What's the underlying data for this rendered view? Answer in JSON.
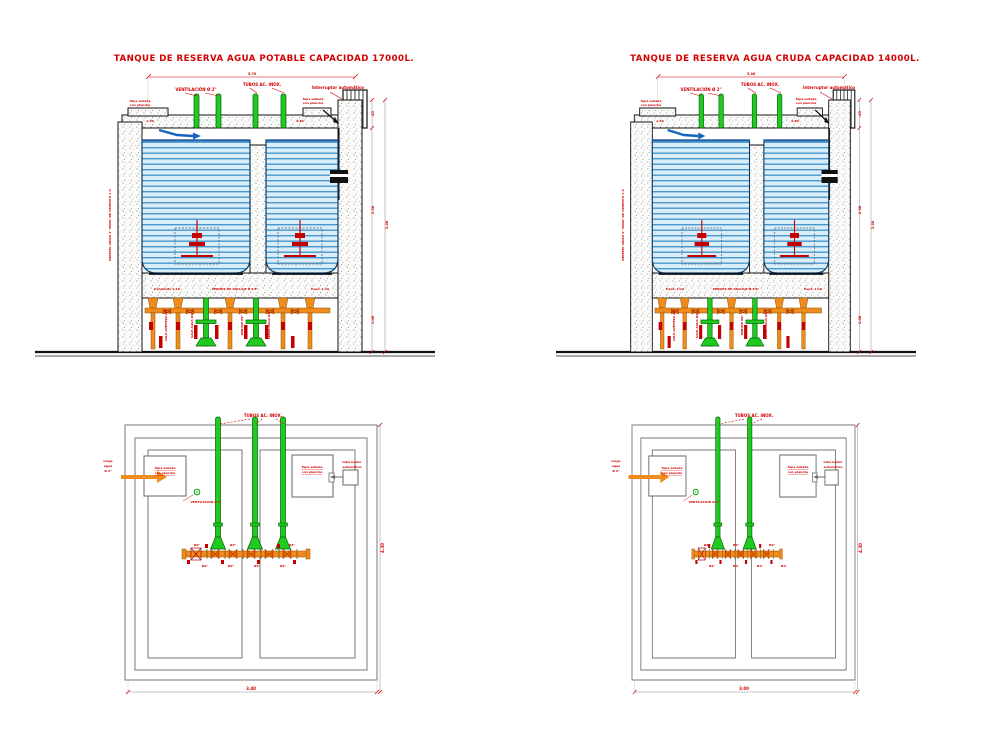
{
  "section_left": {
    "title": "TANQUE DE RESERVA AGUA POTABLE CAPACIDAD 17000L.",
    "dim_top": "3.70",
    "dim_right_top": ".45",
    "dim_right_mid": "2.30",
    "dim_right_total": "3.40",
    "dim_right_bottom": "1.00",
    "slab_dim_left": "1.50",
    "slab_dim_right": "0.80",
    "label_vent": "VENTILACIÓN Ø 2\"",
    "label_tubes": "TUBOS AC. INOX.",
    "label_switch": "Interruptor automático",
    "cover_left_l1": "Tapa sellada",
    "cover_left_l2": "con plancha",
    "cover_right_l1": "Tapa sellada",
    "cover_right_l2": "con plancha",
    "label_wall": "IMPERM. MURO 2\" MORT. DE CEMENTO 1:3",
    "label_slope_left": "Pendiente 1:10",
    "label_anchor": "PERNOS DE ANCLAJE Ø 3/8\"",
    "label_slope_right": "Pend. 1:10",
    "pipe_labels": [
      "SALE LIMPIEZA Ø2\"",
      "SALE AGUA Ø2\"",
      "REBOSE Ø2\"",
      "LLEGA AGUA Ø2\""
    ]
  },
  "section_right": {
    "title": "TANQUE DE RESERVA AGUA CRUDA CAPACIDAD 14000L.",
    "dim_top": "3.40",
    "dim_right_top": ".45",
    "dim_right_mid": "2.30",
    "dim_right_total": "3.40",
    "dim_right_bottom": "1.00",
    "slab_dim_left": "1.50",
    "slab_dim_right": "0.80",
    "label_vent": "VENTILACIÓN Ø 2\"",
    "label_tubes": "TUBOS AC. INOX.",
    "label_switch": "Interruptor automático",
    "cover_left_l1": "Tapa sellada",
    "cover_left_l2": "con plancha",
    "cover_right_l1": "Tapa sellada",
    "cover_right_l2": "con plancha",
    "label_wall": "IMPERM. MURO 2\" MORT. DE CEMENTO 1:3",
    "label_slope_left": "Pend. 1:10",
    "label_anchor": "PERNOS DE ANCLAJE Ø 3/8\"",
    "label_slope_right": "Pend. 1:10",
    "pipe_labels": [
      "SALE LIMPIEZA Ø2\"",
      "SALE AGUA Ø2\"",
      "REBOSE Ø2\"",
      "LLEGA AGUA Ø2\""
    ]
  },
  "plan_left": {
    "label_tubes": "TUBOS AC. INOX.",
    "cover_left_l1": "Tapa sellada",
    "cover_left_l2": "con plancha",
    "cover_right_l1": "Tapa sellada",
    "cover_right_l2": "con plancha",
    "switch_l1": "Interruptor",
    "switch_l2": "automático",
    "inlet_l1": "Llega",
    "inlet_l2": "agua",
    "inlet_l3": "Ø 2\"",
    "label_vent": "VENTILACIÓN Ø 2\"",
    "dim_bottom": "3.40",
    "dim_side": "4.30",
    "manifold_labels": [
      "Ø2\"",
      "Ø2\"",
      "Ø2\"",
      "Ø2\"",
      "Ø2\"",
      "Ø2\"",
      "Ø2\""
    ]
  },
  "plan_right": {
    "label_tubes": "TUBOS AC. INOX.",
    "cover_left_l1": "Tapa sellada",
    "cover_left_l2": "con plancha",
    "cover_right_l1": "Tapa sellada",
    "cover_right_l2": "con plancha",
    "switch_l1": "Interruptor",
    "switch_l2": "automático",
    "inlet_l1": "Llega",
    "inlet_l2": "agua",
    "inlet_l3": "Ø 2\"",
    "label_vent": "VENTILACIÓN Ø 2\"",
    "dim_bottom": "3.00",
    "dim_side": "4.30",
    "manifold_labels": [
      "Ø2\"",
      "Ø2\"",
      "Ø2\"",
      "Ø2\"",
      "Ø2\"",
      "Ø2\"",
      "Ø2\""
    ]
  },
  "colors": {
    "annotation_red": "#d40000",
    "pipe_green": "#1ecb1e",
    "fitting_orange": "#f08c1e",
    "water_blue": "#4a97cc",
    "inlet_blue": "#1565c0"
  }
}
